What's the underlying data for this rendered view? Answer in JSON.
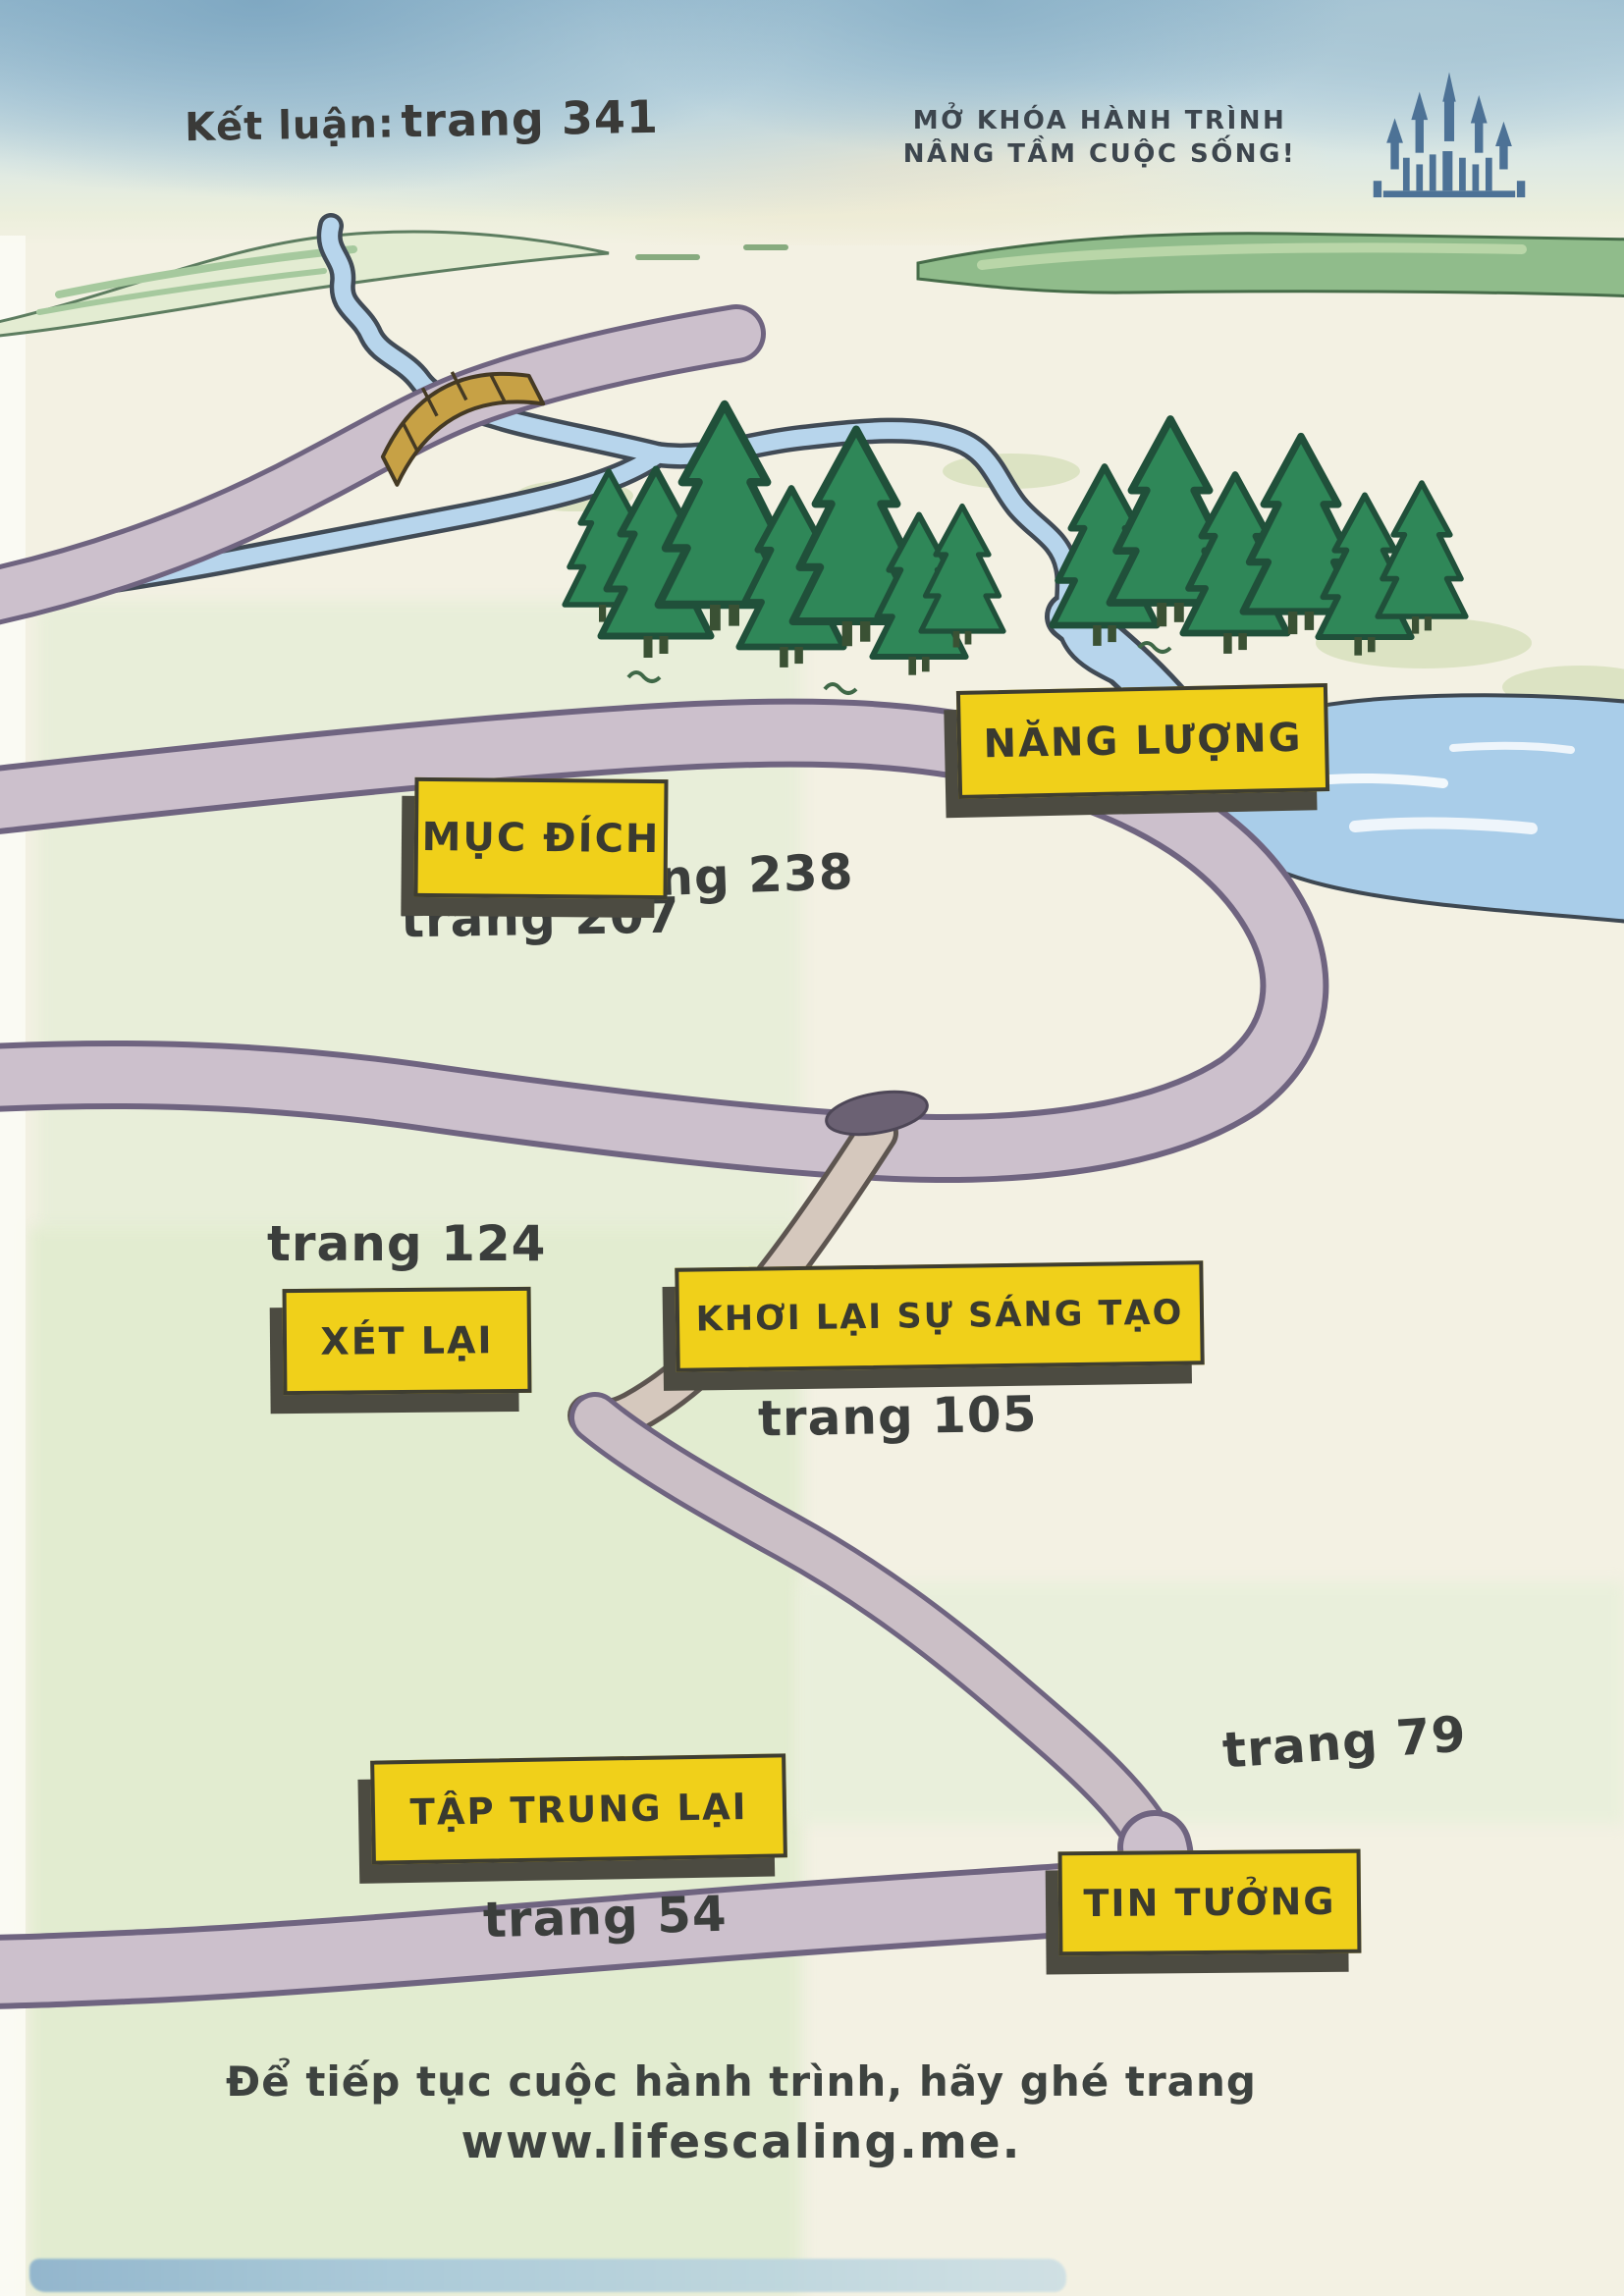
{
  "header": {
    "conclusion_prefix": "Kết luận:",
    "conclusion_page": "trang 341",
    "tagline_line1": "MỞ KHÓA HÀNH TRÌNH",
    "tagline_line2": "NÂNG TẦM CUỘC SỐNG!",
    "icon": "castle-icon"
  },
  "map": {
    "stops": [
      {
        "label": "NĂNG LƯỢNG",
        "page": "trang 238"
      },
      {
        "label": "MỤC ĐÍCH",
        "page": "trang 207"
      },
      {
        "label": "XÉT LẠI",
        "page": "trang 124"
      },
      {
        "label": "KHƠI LẠI SỰ SÁNG TẠO",
        "page": "trang 105"
      },
      {
        "label": "TẬP TRUNG LẠI",
        "page": "trang 54"
      },
      {
        "label": "TIN TƯỞNG",
        "page": "trang 79"
      }
    ]
  },
  "footer": {
    "line1": "Để tiếp tục cuộc hành trình, hãy ghé trang",
    "line2": "www.lifescaling.me."
  },
  "colors": {
    "sign_yellow": "#f0d01a",
    "sign_shadow": "#4c4b41",
    "text_dark": "#3b3e3c",
    "road": "#ccc0cc",
    "road_edge": "#6f6480",
    "water": "#b7d5ec",
    "water_edge": "#414b56",
    "tree_green": "#2f8758",
    "castle_blue": "#4d7296"
  }
}
